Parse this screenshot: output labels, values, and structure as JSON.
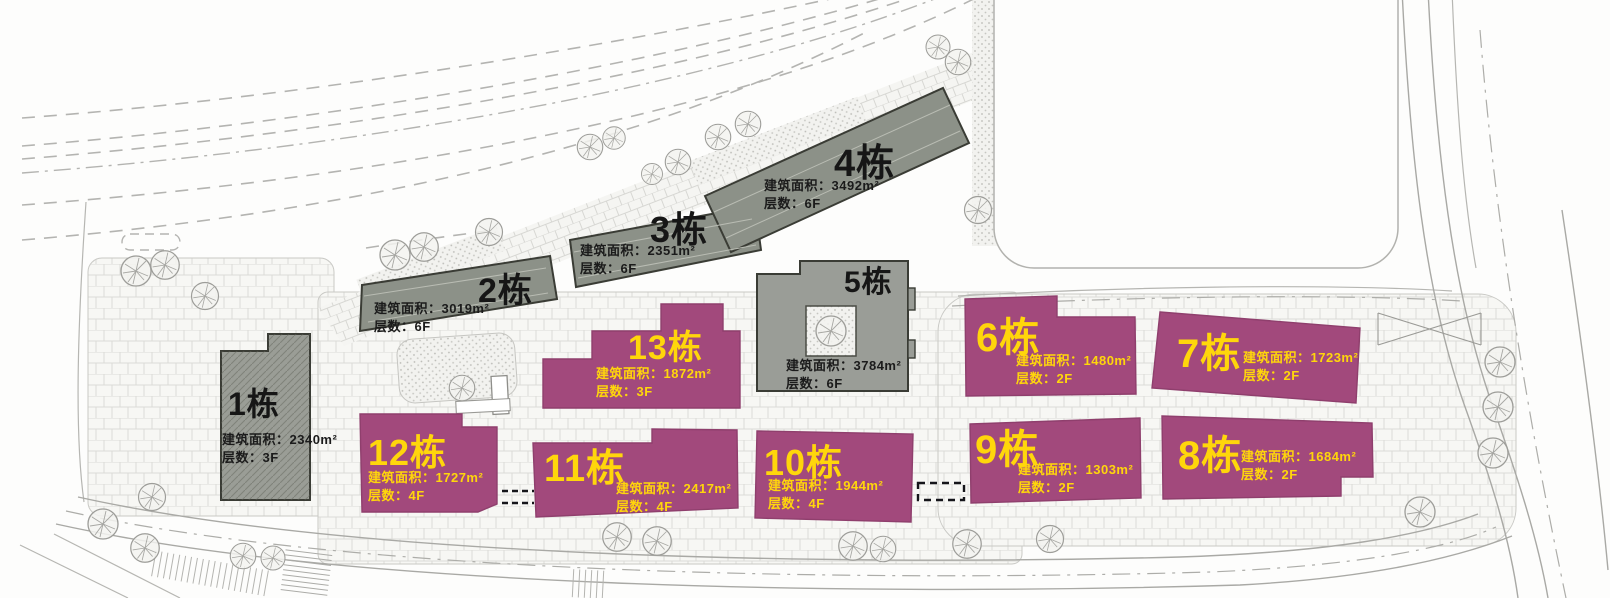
{
  "plan": {
    "type": "architectural-site-plan",
    "labels": {
      "area_label": "建筑面积：",
      "floors_label": "层数："
    },
    "colors": {
      "gray_building": "#8c9188",
      "gray_building_border": "#3a3c35",
      "magenta_building": "#a2497c",
      "label_yellow": "#ffd60b",
      "label_black": "#161616",
      "paving_line": "#dbdbd7",
      "road_line": "#a9a9a5"
    }
  },
  "buildings": [
    {
      "name": "1栋",
      "area": "2340m²",
      "floors": "3F",
      "color_key": "gray"
    },
    {
      "name": "2栋",
      "area": "3019m²",
      "floors": "6F",
      "color_key": "gray"
    },
    {
      "name": "3栋",
      "area": "2351m²",
      "floors": "6F",
      "color_key": "gray"
    },
    {
      "name": "4栋",
      "area": "3492m²",
      "floors": "6F",
      "color_key": "gray"
    },
    {
      "name": "5栋",
      "area": "3784m²",
      "floors": "6F",
      "color_key": "gray"
    },
    {
      "name": "6栋",
      "area": "1480m²",
      "floors": "2F",
      "color_key": "magenta"
    },
    {
      "name": "7栋",
      "area": "1723m²",
      "floors": "2F",
      "color_key": "magenta"
    },
    {
      "name": "8栋",
      "area": "1684m²",
      "floors": "2F",
      "color_key": "magenta"
    },
    {
      "name": "9栋",
      "area": "1303m²",
      "floors": "2F",
      "color_key": "magenta"
    },
    {
      "name": "10栋",
      "area": "1944m²",
      "floors": "4F",
      "color_key": "magenta"
    },
    {
      "name": "11栋",
      "area": "2417m²",
      "floors": "4F",
      "color_key": "magenta"
    },
    {
      "name": "12栋",
      "area": "1727m²",
      "floors": "4F",
      "color_key": "magenta"
    },
    {
      "name": "13栋",
      "area": "1872m²",
      "floors": "3F",
      "color_key": "magenta"
    }
  ]
}
